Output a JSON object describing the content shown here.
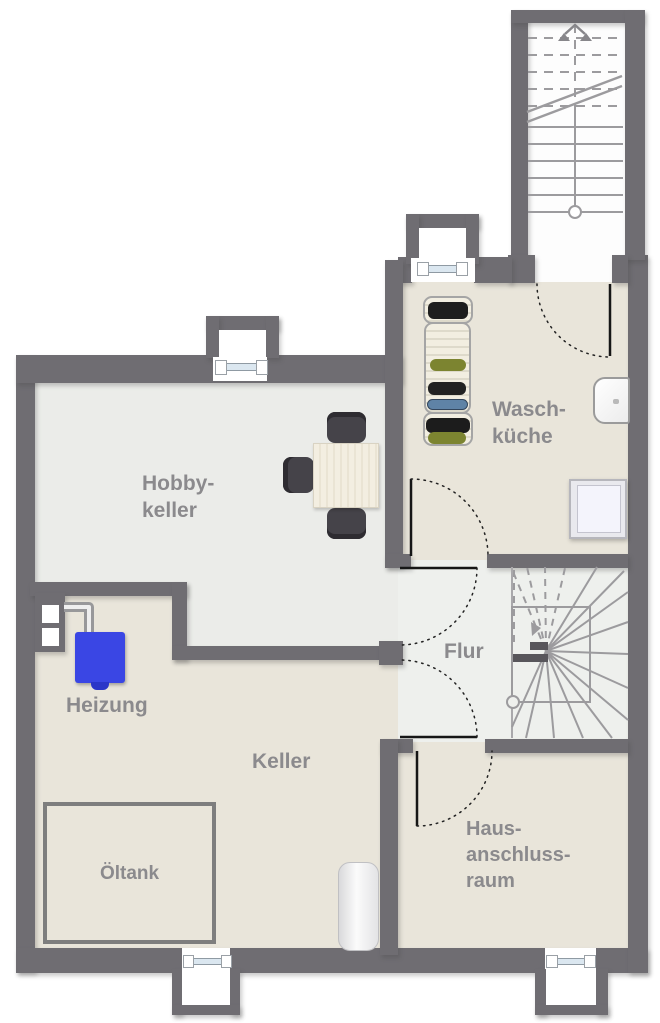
{
  "colors": {
    "wall": "#6f6d72",
    "floor-beige": "#e9e5da",
    "floor-gray": "#ebece9",
    "floor-light": "#eef0ed",
    "label": "#8b8a8d",
    "boiler": "#3a46e4",
    "line": "#9c9b9e",
    "pane": "#dbe7f0"
  },
  "rooms": {
    "hobbykeller": {
      "line1": "Hobby-",
      "line2": "keller"
    },
    "waschkueche": {
      "line1": "Wasch-",
      "line2": "küche"
    },
    "flur": {
      "label": "Flur"
    },
    "heizung": {
      "label": "Heizung"
    },
    "keller": {
      "label": "Keller"
    },
    "oeltank": {
      "label": "Öltank"
    },
    "hausanschlussraum": {
      "line1": "Haus-",
      "line2": "anschluss-",
      "line3": "raum"
    }
  }
}
